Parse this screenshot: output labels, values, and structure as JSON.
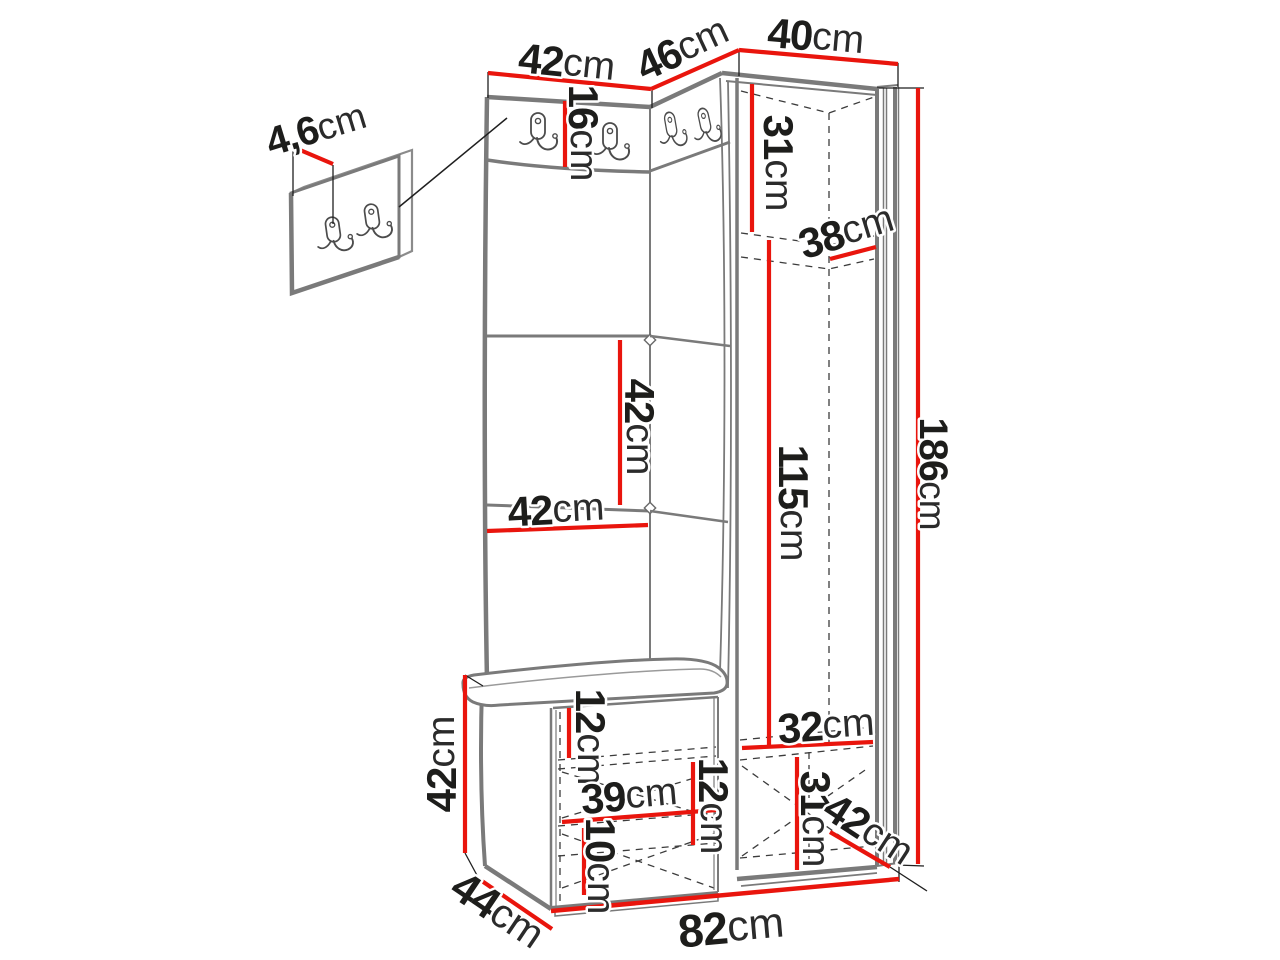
{
  "diagram": {
    "unit": "cm",
    "colors": {
      "dimension_red": "#e9150d",
      "outline_gray": "#7a7a7a",
      "hidden_line": "#3c3c3c",
      "text_dark": "#1d1d1b",
      "background": "#ffffff"
    },
    "dimensions": [
      {
        "id": "wall-panel-thickness",
        "value": "4,6",
        "unit": "cm",
        "x": 316,
        "y": 129,
        "rotate": -17,
        "size": 40
      },
      {
        "id": "left-panel-width",
        "value": "42",
        "unit": "cm",
        "x": 567,
        "y": 62,
        "rotate": 6,
        "size": 42
      },
      {
        "id": "corner-panel-width",
        "value": "46",
        "unit": "cm",
        "x": 682,
        "y": 48,
        "rotate": -25,
        "size": 42
      },
      {
        "id": "wardrobe-width",
        "value": "40",
        "unit": "cm",
        "x": 816,
        "y": 36,
        "rotate": 5,
        "size": 42
      },
      {
        "id": "hook-rail-height",
        "value": "16",
        "unit": "cm",
        "x": 584,
        "y": 133,
        "rotate": 90,
        "size": 42
      },
      {
        "id": "wardrobe-top-section-height",
        "value": "31",
        "unit": "cm",
        "x": 779,
        "y": 163,
        "rotate": 90,
        "size": 42
      },
      {
        "id": "wardrobe-shelf-depth",
        "value": "38",
        "unit": "cm",
        "x": 846,
        "y": 231,
        "rotate": -17,
        "size": 42
      },
      {
        "id": "panel-tile-height",
        "value": "42",
        "unit": "cm",
        "x": 640,
        "y": 427,
        "rotate": 90,
        "size": 42
      },
      {
        "id": "panel-tile-width",
        "value": "42",
        "unit": "cm",
        "x": 556,
        "y": 509,
        "rotate": -3,
        "size": 42
      },
      {
        "id": "wardrobe-hanging-height",
        "value": "115",
        "unit": "cm",
        "x": 794,
        "y": 503,
        "rotate": 90,
        "size": 42
      },
      {
        "id": "total-height",
        "value": "186",
        "unit": "cm",
        "x": 933,
        "y": 474,
        "rotate": 90,
        "size": 40
      },
      {
        "id": "bench-height",
        "value": "42",
        "unit": "cm",
        "x": 441,
        "y": 764,
        "rotate": -90,
        "size": 42
      },
      {
        "id": "bench-top-section-height",
        "value": "12",
        "unit": "cm",
        "x": 591,
        "y": 737,
        "rotate": 90,
        "size": 42
      },
      {
        "id": "bench-inner-width",
        "value": "39",
        "unit": "cm",
        "x": 629,
        "y": 795,
        "rotate": -5,
        "size": 42
      },
      {
        "id": "bench-middle-section-height",
        "value": "12",
        "unit": "cm",
        "x": 714,
        "y": 806,
        "rotate": 90,
        "size": 42
      },
      {
        "id": "bench-bottom-section-height",
        "value": "10",
        "unit": "cm",
        "x": 601,
        "y": 866,
        "rotate": 90,
        "size": 42
      },
      {
        "id": "bench-depth",
        "value": "44",
        "unit": "cm",
        "x": 498,
        "y": 910,
        "rotate": 34,
        "size": 44
      },
      {
        "id": "total-width",
        "value": "82",
        "unit": "cm",
        "x": 731,
        "y": 927,
        "rotate": -5,
        "size": 46
      },
      {
        "id": "wardrobe-bottom-inner-width",
        "value": "32",
        "unit": "cm",
        "x": 826,
        "y": 725,
        "rotate": -4,
        "size": 42
      },
      {
        "id": "wardrobe-bottom-section-height",
        "value": "31",
        "unit": "cm",
        "x": 816,
        "y": 819,
        "rotate": 90,
        "size": 42
      },
      {
        "id": "wardrobe-depth",
        "value": "42",
        "unit": "cm",
        "x": 869,
        "y": 829,
        "rotate": 33,
        "size": 42
      }
    ]
  }
}
